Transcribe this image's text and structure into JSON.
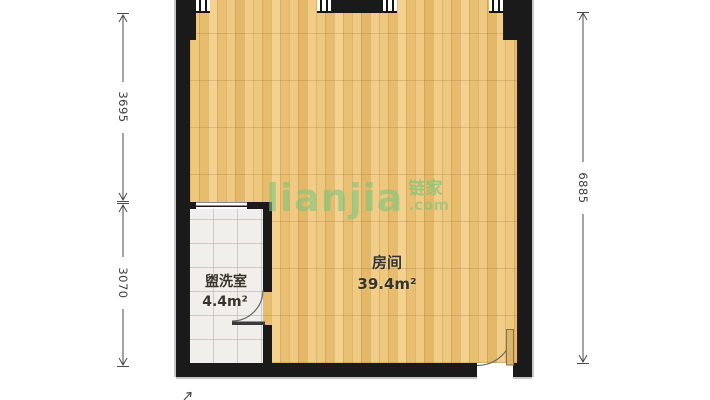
{
  "plan": {
    "rooms": [
      {
        "id": "main-room",
        "name": "房间",
        "area": "39.4m²"
      },
      {
        "id": "washroom",
        "name": "盥洗室",
        "area": "4.4m²"
      }
    ],
    "dimensions": {
      "left_upper": "3695",
      "left_lower": "3070",
      "right": "6885"
    },
    "features": {
      "windows_top_count": 4,
      "doors": [
        "washroom-door",
        "entry-door"
      ]
    }
  },
  "watermark": {
    "brand_latin": "lianjia",
    "brand_cn": "链家",
    "tld": ".com"
  },
  "colors": {
    "wall": "#1a1a1a",
    "wood_floor": "#ecc377",
    "tile_floor": "#f1efec",
    "watermark_green": "#7dc67d",
    "dimension_text": "#3d3d3d",
    "label_text": "#35352e"
  }
}
